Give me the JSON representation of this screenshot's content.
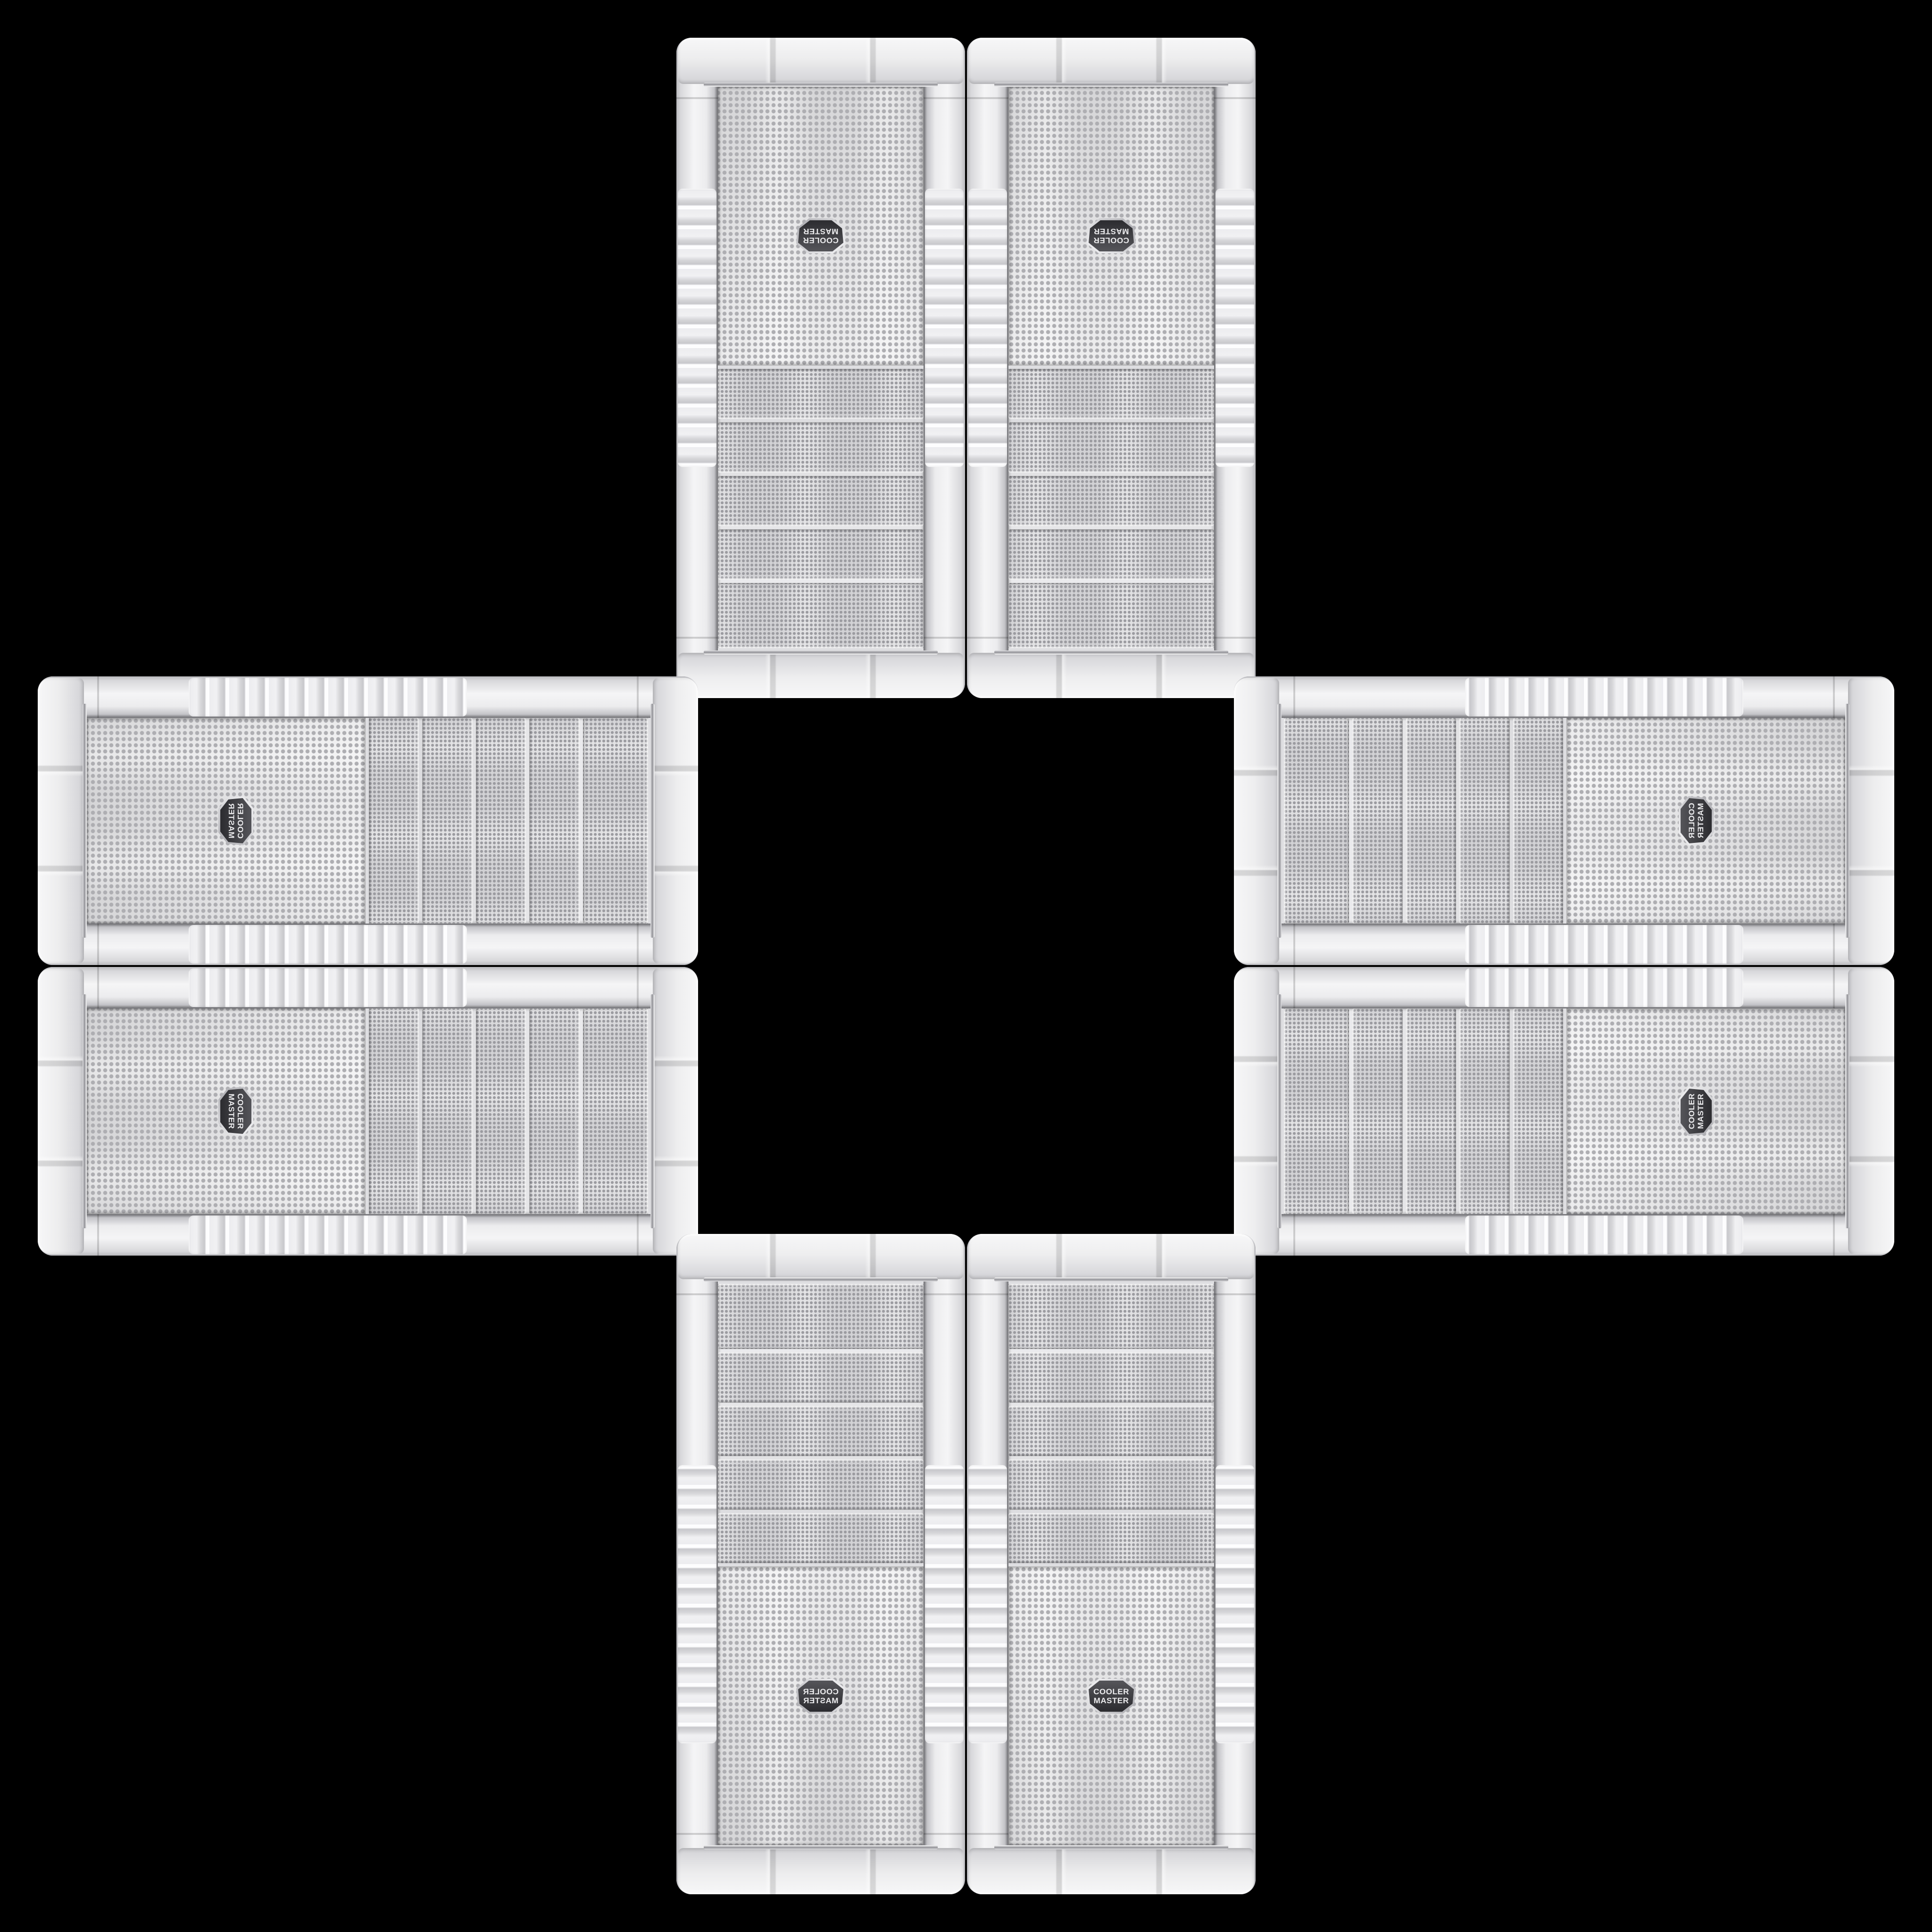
{
  "scene": {
    "description": "Eight identical white Cooler Master tower PC cases photographed front-on, arranged in a plus/cross pattern on a pure black background; drive-bay ends all face the empty black centre square",
    "background_color": "#000000",
    "arrangement": "4 touching pairs: two vertical cases at top, two vertical at bottom, two horizontal at left, two horizontal at right"
  },
  "case_model": {
    "brand": {
      "line1": "COOLER",
      "line2": "MASTER"
    },
    "badge_shape": "hexagonal dark badge with silver rim, centered on lower mesh panel",
    "front_panel": "perforated dot mesh",
    "bay_strip_count": 5,
    "color_finish": "white / light grey plastic with chrome trim lines and ridged grip bands on the side rails"
  },
  "cases": [
    {
      "id": "case-top-left",
      "position": "top pair, left",
      "orientation": "vertical",
      "rotation": "rotated 180°",
      "logo_reads": "upside-down",
      "bays_facing": "down toward center"
    },
    {
      "id": "case-top-right",
      "position": "top pair, right",
      "orientation": "vertical",
      "rotation": "rotated 180°, mirrored",
      "logo_reads": "upside-down",
      "bays_facing": "down toward center"
    },
    {
      "id": "case-left-top",
      "position": "left pair, upper",
      "orientation": "horizontal",
      "rotation": "rotated 90° clockwise",
      "logo_reads": "vertical, bottom-to-top",
      "bays_facing": "right toward center"
    },
    {
      "id": "case-left-bottom",
      "position": "left pair, lower",
      "orientation": "horizontal",
      "rotation": "rotated 90° CW, mirrored",
      "logo_reads": "vertical",
      "bays_facing": "right toward center"
    },
    {
      "id": "case-right-top",
      "position": "right pair, upper",
      "orientation": "horizontal",
      "rotation": "rotated 90° counter-clockwise",
      "logo_reads": "vertical, top-to-bottom",
      "bays_facing": "left toward center"
    },
    {
      "id": "case-right-bottom",
      "position": "right pair, lower",
      "orientation": "horizontal",
      "rotation": "rotated 90° CCW, mirrored",
      "logo_reads": "vertical",
      "bays_facing": "left toward center"
    },
    {
      "id": "case-bottom-left",
      "position": "bottom pair, left",
      "orientation": "vertical",
      "rotation": "upright, mirrored",
      "logo_reads": "mirrored text",
      "bays_facing": "up toward center"
    },
    {
      "id": "case-bottom-right",
      "position": "bottom pair, right",
      "orientation": "vertical",
      "rotation": "upright original",
      "logo_reads": "normal COOLER MASTER",
      "bays_facing": "up toward center"
    }
  ],
  "colors": {
    "bg": "#000000",
    "mesh-base": "#e3e3e5",
    "mesh-dot": "#aeaeb2",
    "bay-base": "#d2d2d5",
    "bay-dot": "#9b9ba0",
    "rail-hi": "#f5f5f6",
    "rail-lo": "#b9b9bd",
    "cap-hi": "#f7f7f8",
    "cap-lo": "#d2d2d6",
    "chrome-dark": "#909095",
    "badge-face": "#3e3e42",
    "badge-rim": "#d9d9dc",
    "badge-text": "#ebebed"
  }
}
